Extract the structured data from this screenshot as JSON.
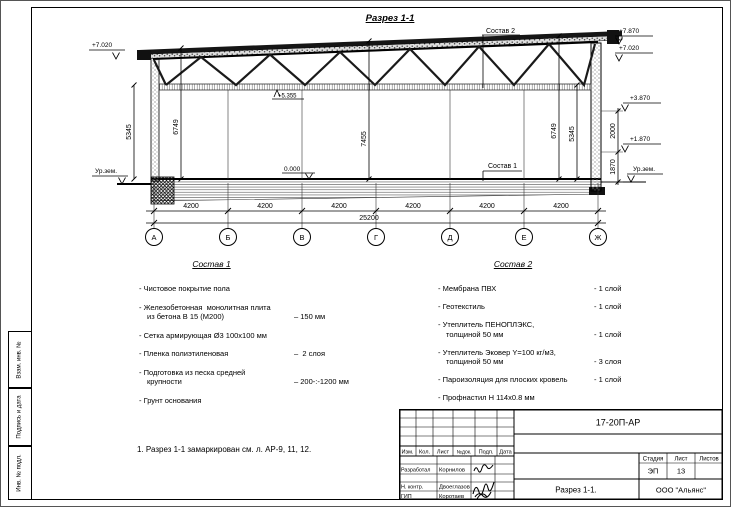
{
  "drawing": {
    "title": "Разрез 1-1",
    "grid_letters": [
      "А",
      "Б",
      "В",
      "Г",
      "Д",
      "Е",
      "Ж"
    ],
    "bay_dim": "4200",
    "total_dim": "25200",
    "dims": {
      "left_inner": "5345",
      "left_outer": "6749",
      "center": "7455",
      "right_outer": "6749",
      "right_inner": "5345",
      "right_upper": "2000",
      "right_lower": "1870"
    },
    "elev": {
      "left_top": "+7.020",
      "right_1": "+7.870",
      "right_2": "+7.020",
      "right_3": "+3.870",
      "right_4": "+1.870",
      "truss": "+5.355",
      "floor": "0.000",
      "ground_left": "Ур.зем.",
      "ground_right": "Ур.зем."
    },
    "callout_1": "Состав 1",
    "callout_2": "Состав 2"
  },
  "lists": {
    "sostav1": {
      "title": "Состав 1",
      "items": [
        {
          "name": "- Чистовое покрытие пола",
          "value": ""
        },
        {
          "name": "- Железобетонная  монолитная плита\nиз бетона В 15 (М200)",
          "value": "– 150 мм"
        },
        {
          "name": "- Сетка армирующая Ø3 100х100 мм",
          "value": ""
        },
        {
          "name": "- Пленка полиэтиленовая",
          "value": "–  2 слоя"
        },
        {
          "name": "- Подготовка из песка средней\nкрупности",
          "value": "– 200-:-1200 мм"
        },
        {
          "name": "- Грунт основания",
          "value": ""
        }
      ]
    },
    "sostav2": {
      "title": "Состав 2",
      "items": [
        {
          "name": "- Мембрана ПВХ",
          "value": "- 1 слой"
        },
        {
          "name": "- Геотекстиль",
          "value": "- 1 слой"
        },
        {
          "name": "- Утеплитель ПЕНОПЛЭКС,\nтолщиной 50 мм",
          "value": "- 1 слой"
        },
        {
          "name": "- Утеплитель Эковер Y=100 кг/м3,\nтолщиной 50 мм",
          "value": "- 3 слоя"
        },
        {
          "name": "- Пароизоляция для плоских кровель",
          "value": "- 1 слой"
        },
        {
          "name": "- Профнастил Н 114х0.8 мм",
          "value": ""
        },
        {
          "name": "- Металлические фермы\n(с торцов балки – проф. труба 160х5 мм)",
          "value": ""
        }
      ]
    }
  },
  "note": "1. Разрез 1-1 замаркирован см. л. АР-9, 11, 12.",
  "margin_labels": {
    "top": "Взам. инв. №",
    "mid": "Подпись и дата",
    "bottom": "Инв. № подл."
  },
  "titleblock": {
    "doc_number": "17-20П-АР",
    "header": {
      "izm": "Изм.",
      "kol": "Кол.",
      "list": "Лист",
      "ndok": "№док.",
      "podp": "Подп.",
      "data": "Дата"
    },
    "rows": [
      {
        "role": "Разработал",
        "name": "Корнилов"
      },
      {
        "role": "Н. контр.",
        "name": "Двоеглазов"
      },
      {
        "role": "ГИП",
        "name": "Коротаев"
      }
    ],
    "stage_header": {
      "stadia": "Стадия",
      "list": "Лист",
      "listov": "Листов"
    },
    "stage": "ЭП",
    "sheet_no": "13",
    "sheets_total": "",
    "sheet_title": "Разрез 1-1.",
    "company": "ООО \"Альянс\""
  }
}
